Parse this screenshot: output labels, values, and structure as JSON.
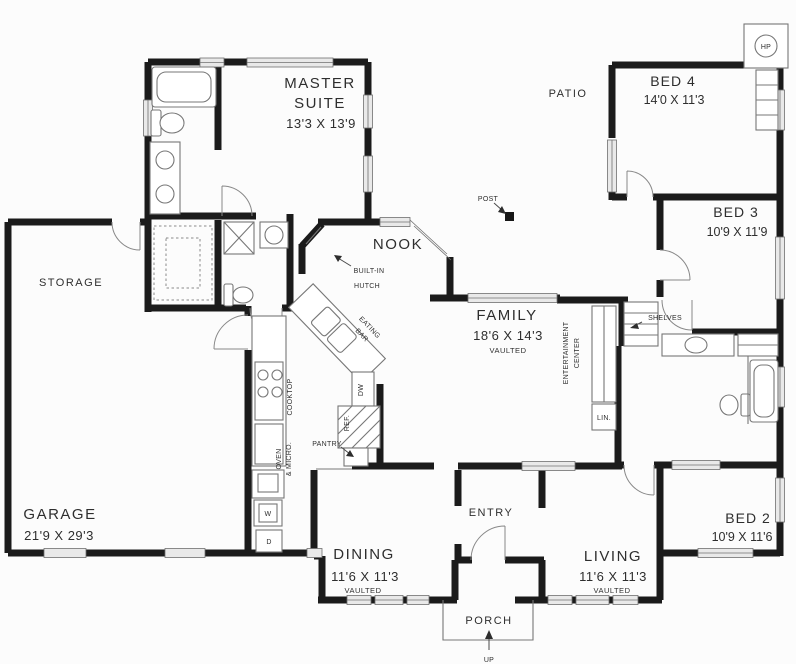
{
  "plan": {
    "rooms": {
      "master_suite": {
        "line1": "MASTER",
        "line2": "SUITE",
        "dims": "13'3 X 13'9"
      },
      "patio": {
        "name": "PATIO"
      },
      "bed4": {
        "name": "BED 4",
        "dims": "14'0 X 11'3"
      },
      "bed3": {
        "name": "BED 3",
        "dims": "10'9 X 11'9"
      },
      "bed2": {
        "name": "BED 2",
        "dims": "10'9 X 11'6"
      },
      "nook": {
        "name": "NOOK"
      },
      "storage": {
        "name": "STORAGE"
      },
      "family": {
        "name": "FAMILY",
        "dims": "18'6 X 14'3",
        "note": "VAULTED"
      },
      "garage": {
        "name": "GARAGE",
        "dims": "21'9 X 29'3"
      },
      "dining": {
        "name": "DINING",
        "dims": "11'6 X 11'3",
        "note": "VAULTED"
      },
      "entry": {
        "name": "ENTRY"
      },
      "living": {
        "name": "LIVING",
        "dims": "11'6 X 11'3",
        "note": "VAULTED"
      },
      "porch": {
        "name": "PORCH"
      }
    },
    "annotations": {
      "hp": "HP",
      "post": "POST",
      "built_in_hutch_line1": "BUILT-IN",
      "built_in_hutch_line2": "HUTCH",
      "eating_bar_line1": "EATING",
      "eating_bar_line2": "BAR",
      "cooktop": "COOKTOP",
      "oven_line1": "OVEN",
      "oven_line2": "& MICRO.",
      "ref": "REF.",
      "dw": "DW",
      "pantry": "PANTRY",
      "entertainment_line1": "ENTERTAINMENT",
      "entertainment_line2": "CENTER",
      "shelves": "SHELVES",
      "linen": "LIN.",
      "washer": "W",
      "dryer": "D",
      "up": "UP"
    },
    "colors": {
      "wall": "#1b1b1b",
      "text": "#2e2e2e",
      "fixture": "#777777",
      "window_fill": "#e9e9e9",
      "background": "#fcfcfc"
    }
  }
}
